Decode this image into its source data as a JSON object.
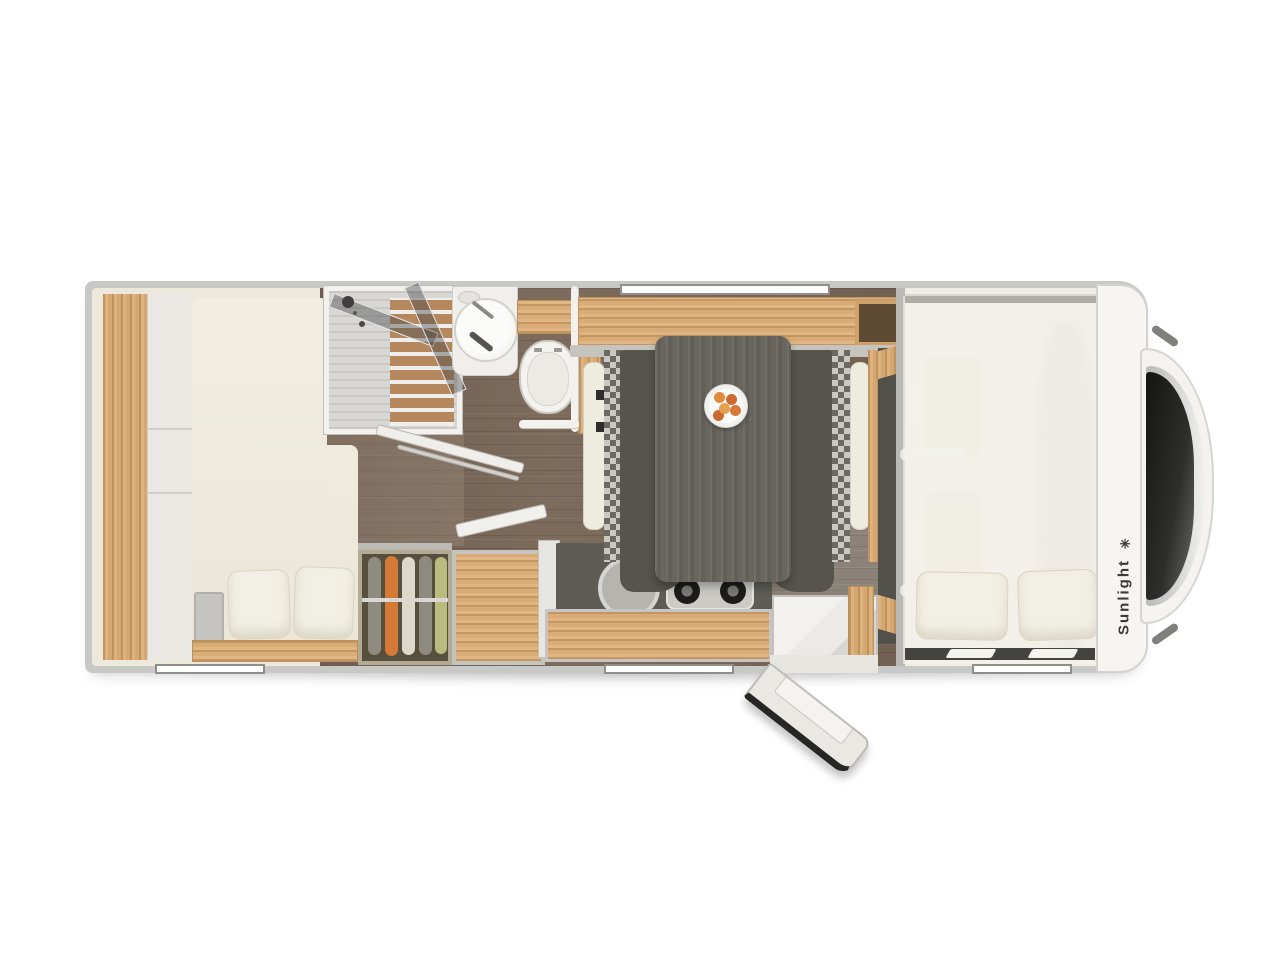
{
  "brand": {
    "name": "Sunlight",
    "logo_glyph": "✳"
  },
  "colors": {
    "page_background": "#ffffff",
    "body_shell": "#c8c8c6",
    "interior": "#ece8dc",
    "oak_wood": "#d6a871",
    "floor_wood": "#7d6b5c",
    "dinette_seat": "#56544d",
    "counter_gray": "#5e5c55",
    "mattress_cream": "#f0ecdf",
    "accent_cloth_orange": "#d57a36",
    "accent_cloth_green": "#b9bc7e",
    "windshield_glass": "#1f1f1d"
  },
  "fixtures": [
    "rear-bed",
    "bed-pillows",
    "wardrobe-with-clothes",
    "storage-cabinet",
    "shower-cabin",
    "washbasin",
    "toilet",
    "bathroom-door",
    "kitchen-sink",
    "gas-hob",
    "kitchen-counter",
    "dinette-table",
    "fruit-plate",
    "dinette-bench-left",
    "dinette-bench-right",
    "overhead-cabinet",
    "entry-step",
    "entry-door-open",
    "cab-seats",
    "overcab-bed",
    "overcab-pillows",
    "windshield",
    "brand-logo"
  ]
}
